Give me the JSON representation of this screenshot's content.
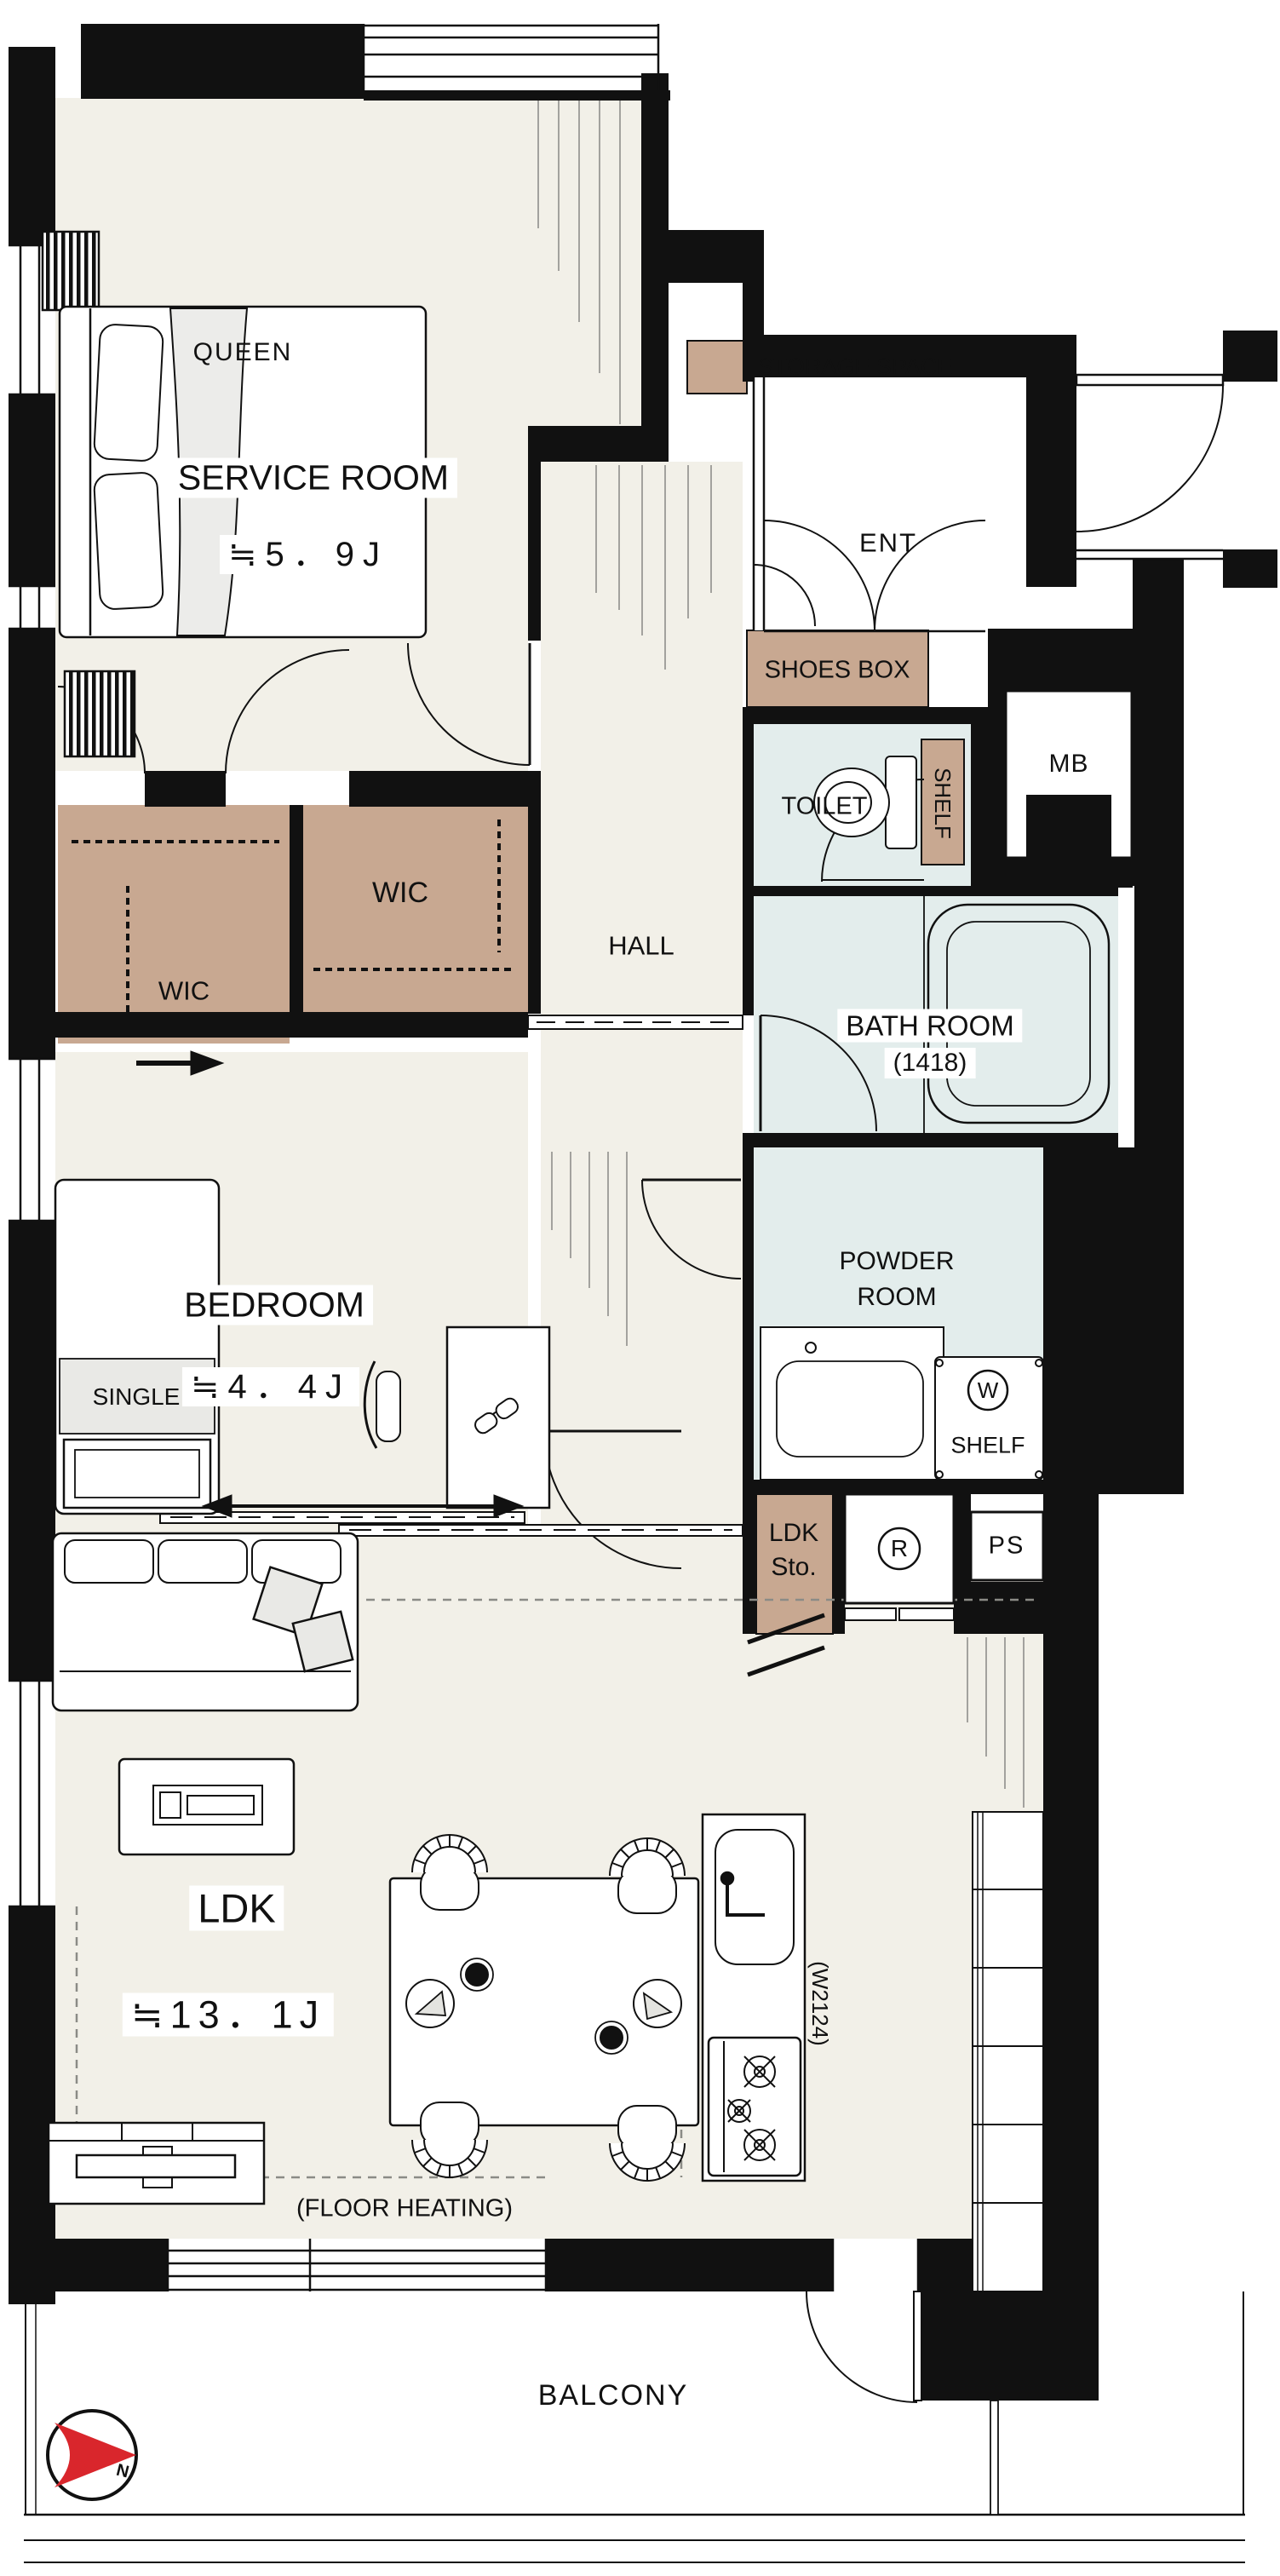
{
  "legend": {
    "storage": "STORAGE SPACE"
  },
  "labels": {
    "queen": "QUEEN",
    "service_room": "SERVICE ROOM",
    "service_size": "≒5．9J",
    "ent": "ENT",
    "shoes_box": "SHOES BOX",
    "mb": "MB",
    "toilet": "TOILET",
    "toilet_shelf": "SHELF",
    "wic_left": "WIC",
    "wic_right": "WIC",
    "hall": "HALL",
    "bath": "BATH ROOM",
    "bath_size": "(1418)",
    "bedroom": "BEDROOM",
    "bedroom_size": "≒4．4J",
    "single": "SINGLE",
    "powder_line1": "POWDER",
    "powder_line2": "ROOM",
    "washer": "W",
    "powder_shelf": "SHELF",
    "ldk_sto_line1": "LDK",
    "ldk_sto_line2": "Sto.",
    "fridge": "R",
    "ps": "PS",
    "ldk": "LDK",
    "ldk_size": "≒13．1J",
    "floor_heating": "(FLOOR HEATING)",
    "kitchen_width": "(W2124)",
    "balcony": "BALCONY",
    "compass_north": "N"
  },
  "colors": {
    "storage_fill": "#c8a891",
    "water_fill": "#e3edec",
    "floor_fill": "#f2f0e8",
    "wall": "#111111",
    "compass_red": "#d9262c"
  }
}
